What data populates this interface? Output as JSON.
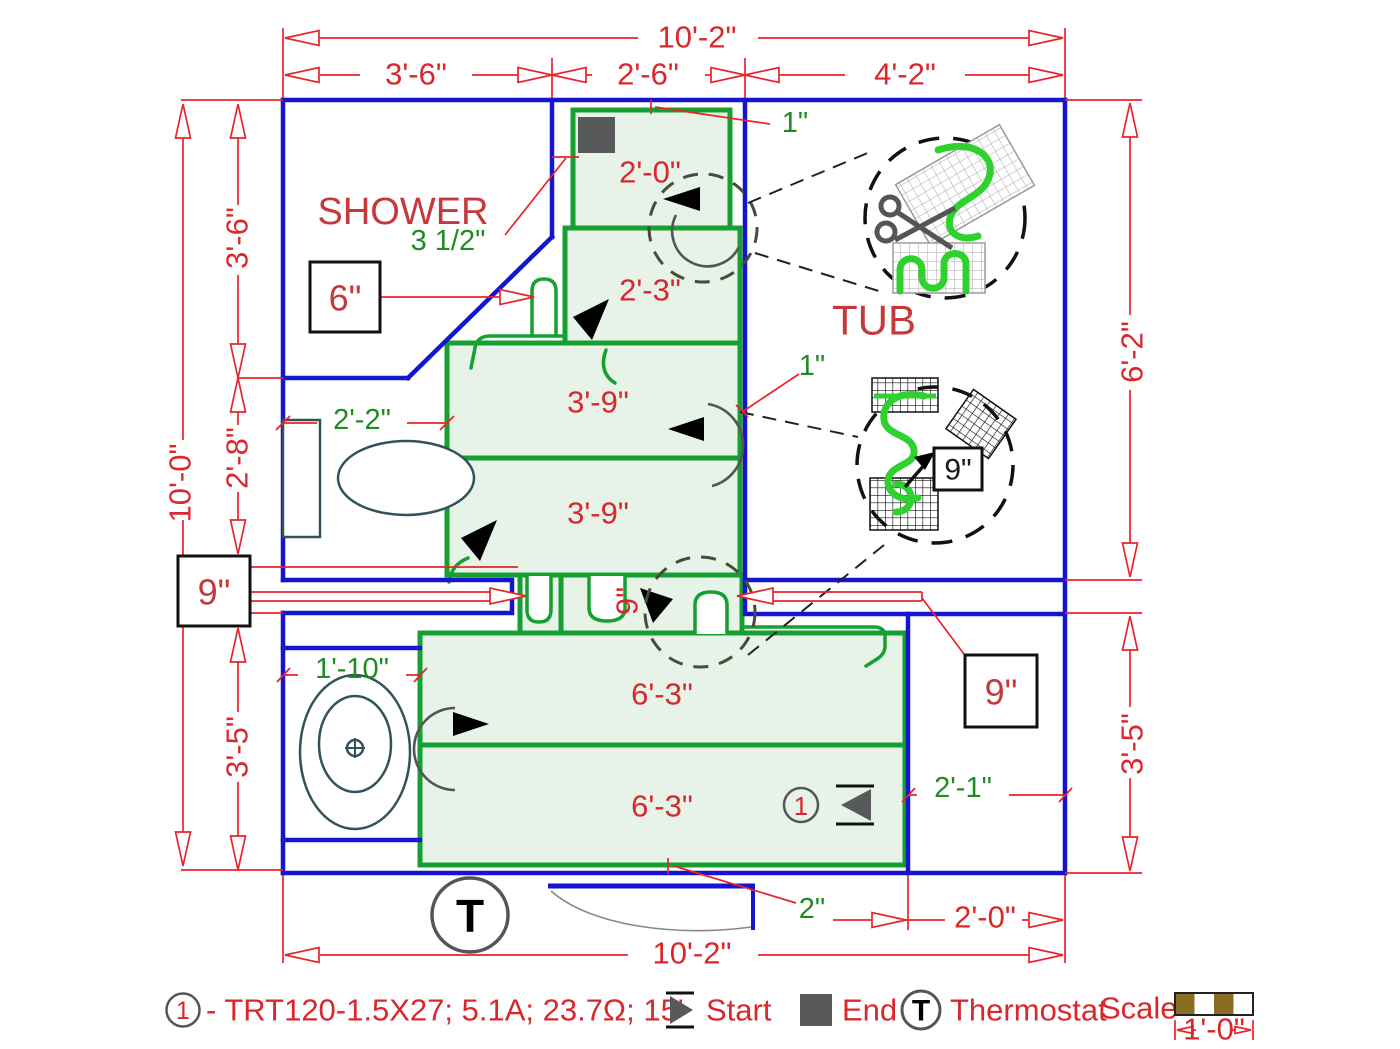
{
  "colors": {
    "wall_blue": "#1515cf",
    "mat_green": "#16a032",
    "mat_fill": "#e7f3e8",
    "dimension_red": "#e8242a",
    "label_green": "#1e8c22",
    "dark_gray": "#58595b",
    "scale_brown": "#8a6d23"
  },
  "rooms": {
    "shower": "SHOWER",
    "tub": "TUB"
  },
  "dims": {
    "top_total": "10'-2\"",
    "top_a": "3'-6\"",
    "top_b": "2'-6\"",
    "top_c": "4'-2\"",
    "left_total": "10'-0\"",
    "left_a": "3'-6\"",
    "left_b": "2'-8\"",
    "left_c": "3'-5\"",
    "right_a": "6'-2\"",
    "right_b": "3'-5\"",
    "bottom_total": "10'-2\"",
    "bottom_right": "2'-0\""
  },
  "mat_labels": {
    "s1": "2'-0\"",
    "s2": "2'-3\"",
    "s3": "3'-9\"",
    "s4": "3'-9\"",
    "s5": "6'-3\"",
    "s6": "6'-3\""
  },
  "callouts": {
    "spacing": "3 1/2\"",
    "edge_top": "1\"",
    "edge_mid": "1\"",
    "offset_6": "6\"",
    "offset_9_left": "9\"",
    "offset_9_right": "9\"",
    "corridor_9": "9\"",
    "detail_9": "9\"",
    "vanity": "2'-2\"",
    "toilet": "1'-10\"",
    "niche": "2'-1\"",
    "door": "2\""
  },
  "plan": {
    "thermostat_symbol": "T",
    "circuit_no": "1"
  },
  "legend": {
    "circuit_no": "1",
    "circuit_desc": "- TRT120-1.5X27; 5.1A; 23.7Ω; 15'",
    "start": "Start",
    "end": "End",
    "thermostat_symbol": "T",
    "thermostat": "Thermostat",
    "scale": "Scale",
    "scale_length": "1'-0\""
  }
}
